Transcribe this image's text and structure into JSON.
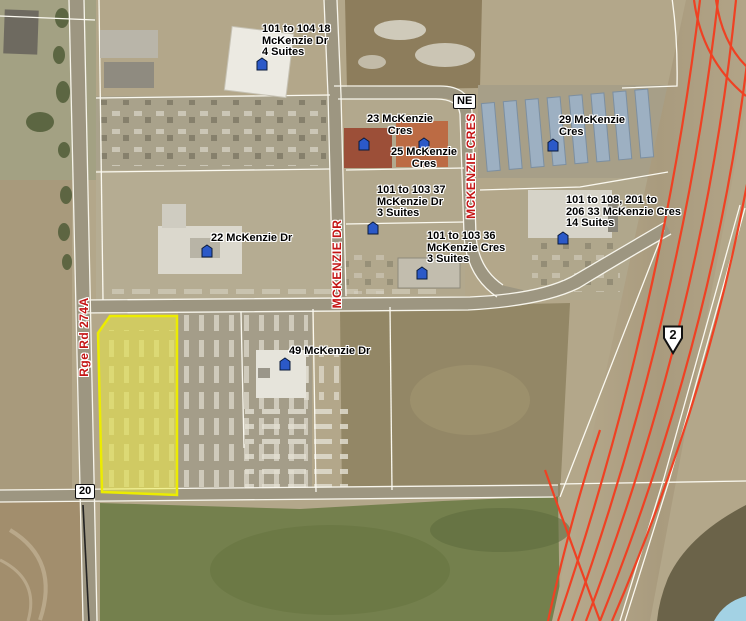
{
  "map": {
    "section_label": "NE",
    "highway_label": "20",
    "highway_shield": "2",
    "road_labels": {
      "mckenzie_cres": "MCKENZIE CRES",
      "mckenzie_dr": "MCKENZIE DR",
      "rge_rd_274a": "Rge Rd 274A"
    },
    "address_labels": [
      {
        "id": "18-mckenzie-dr",
        "lines": [
          "101 to 104 18",
          "McKenzie Dr",
          "4 Suites"
        ]
      },
      {
        "id": "23-mckenzie-cres",
        "lines": [
          "23 McKenzie",
          "Cres"
        ]
      },
      {
        "id": "25-mckenzie-cres",
        "lines": [
          "25 McKenzie",
          "Cres"
        ]
      },
      {
        "id": "37-mckenzie-dr",
        "lines": [
          "101 to 103 37",
          "McKenzie Dr",
          "3 Suites"
        ]
      },
      {
        "id": "29-mckenzie-cres",
        "lines": [
          "29 McKenzie",
          "Cres"
        ]
      },
      {
        "id": "33-mckenzie-cres",
        "lines": [
          "101 to 108, 201 to",
          "206 33 McKenzie Cres",
          "14 Suites"
        ]
      },
      {
        "id": "22-mckenzie-dr",
        "lines": [
          "22 McKenzie Dr"
        ]
      },
      {
        "id": "36-mckenzie-cres",
        "lines": [
          "101 to 103 36",
          "McKenzie Cres",
          "3 Suites"
        ]
      },
      {
        "id": "49-mckenzie-dr",
        "lines": [
          "49 McKenzie Dr"
        ]
      }
    ],
    "colors": {
      "highway_line": "#ef4123",
      "street_label_red": "#c41414",
      "parcel_highlight_fill": "#eeee3c",
      "parcel_highlight_stroke": "#ecec00",
      "building_marker_blue": "#2b59c8",
      "water": "#a3d2e4",
      "ground_tan": "#b3a78a",
      "field_green": "#74804d"
    }
  }
}
